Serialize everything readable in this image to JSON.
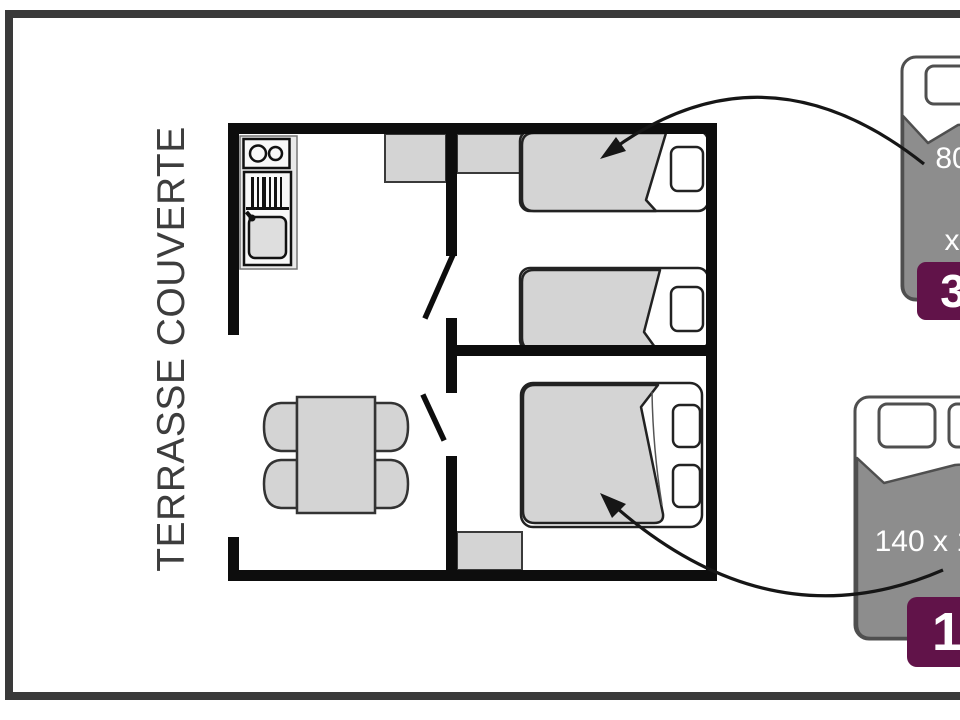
{
  "terrace_label": "TERRASSE COUVERTE",
  "callouts": {
    "single_bed": {
      "icon": "single-bed-icon",
      "dim_line1": "80",
      "dim_line2": "x",
      "dim_line3": "190",
      "count": "3"
    },
    "double_bed": {
      "icon": "double-bed-icon",
      "dimensions": "140 x 190",
      "count": "1"
    }
  },
  "colors": {
    "wall": "#0d0d0d",
    "furniture": "#d4d4d4",
    "callout-gray": "#8d8d8d",
    "badge": "#611349",
    "frame": "#3a3a3a",
    "text": "#3d3d3d"
  }
}
